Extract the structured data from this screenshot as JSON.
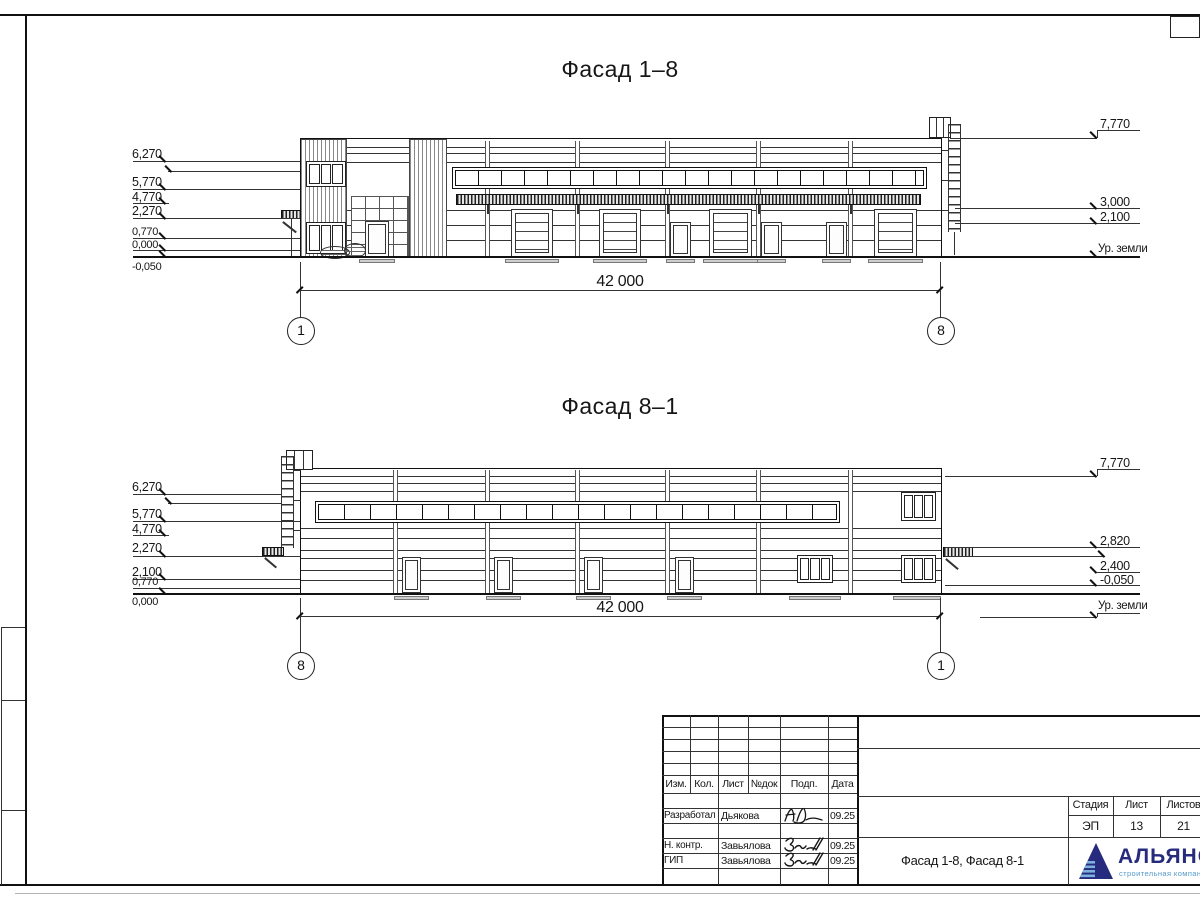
{
  "sheet": {
    "facade_top": {
      "title": "Фасад 1–8",
      "dimension": "42 000",
      "axis_left": "1",
      "axis_right": "8",
      "left_marks": [
        "6,270",
        "5,770",
        "4,770",
        "2,270",
        "0,770",
        "0,000",
        "-0,050"
      ],
      "right_marks": [
        "7,770",
        "3,000",
        "2,100",
        "Ур. земли"
      ]
    },
    "facade_bottom": {
      "title": "Фасад 8–1",
      "dimension": "42 000",
      "axis_left": "8",
      "axis_right": "1",
      "left_marks": [
        "6,270",
        "5,770",
        "4,770",
        "2,270",
        "2,100",
        "0,770",
        "0,000"
      ],
      "right_marks": [
        "7,770",
        "2,820",
        "2,400",
        "-0,050",
        "Ур. земли"
      ]
    },
    "title_block": {
      "columns": [
        "Изм.",
        "Кол.",
        "Лист",
        "№док",
        "Подп.",
        "Дата"
      ],
      "rows": [
        {
          "role": "Разработал",
          "name": "Дьякова",
          "date": "09.25"
        },
        {
          "role": "Н. контр.",
          "name": "Завьялова",
          "date": "09.25"
        },
        {
          "role": "ГИП",
          "name": "Завьялова",
          "date": "09.25"
        }
      ],
      "stage_label": "Стадия",
      "sheet_label": "Лист",
      "sheets_label": "Листов",
      "stage": "ЭП",
      "sheet_no": "13",
      "sheets_total": "21",
      "doc_title": "Фасад 1-8, Фасад 8-1",
      "company_name": "АЛЬЯНС",
      "company_tagline": "строительная компания",
      "brand_dark": "#262b7e",
      "brand_light": "#5599cc"
    }
  }
}
